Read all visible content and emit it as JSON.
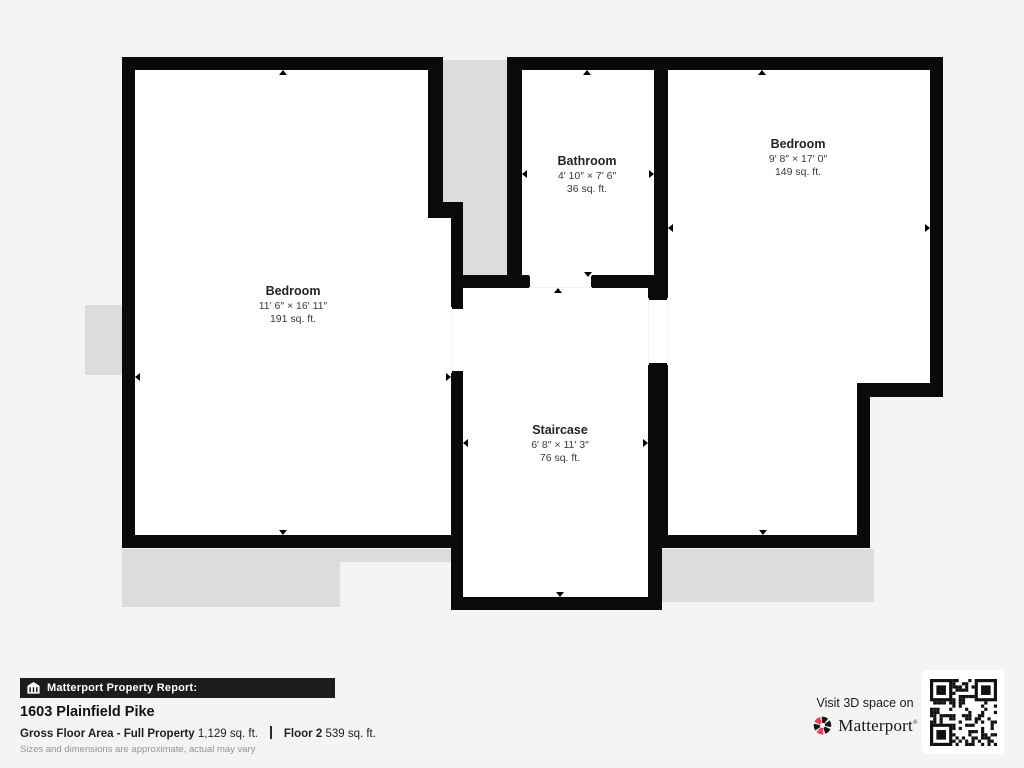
{
  "floorplan": {
    "rooms": [
      {
        "id": "bedroom-left",
        "name": "Bedroom",
        "dimensions": "11′ 6″ × 16′ 11″",
        "area": "191 sq. ft."
      },
      {
        "id": "bathroom",
        "name": "Bathroom",
        "dimensions": "4′ 10″ × 7′ 6″",
        "area": "36 sq. ft."
      },
      {
        "id": "bedroom-right",
        "name": "Bedroom",
        "dimensions": "9′ 8″ × 17′ 0″",
        "area": "149 sq. ft."
      },
      {
        "id": "staircase",
        "name": "Staircase",
        "dimensions": "6′ 8″ × 11′ 3″",
        "area": "76 sq. ft."
      }
    ],
    "colors": {
      "wall": "#0a0a0a",
      "exterior": "#dcdcdc",
      "background": "#f4f4f2"
    }
  },
  "report": {
    "bar_label": "Matterport Property Report:",
    "address": "1603 Plainfield Pike",
    "gross_label": "Gross Floor Area - Full Property",
    "gross_value": "1,129 sq. ft.",
    "floor_label": "Floor 2",
    "floor_value": "539 sq. ft.",
    "disclaimer": "Sizes and dimensions are approximate, actual may vary"
  },
  "promo": {
    "visit_text": "Visit 3D space on",
    "brand": "Matterport",
    "brand_mark": "®",
    "logo_accent_color": "#ee3c5c"
  }
}
